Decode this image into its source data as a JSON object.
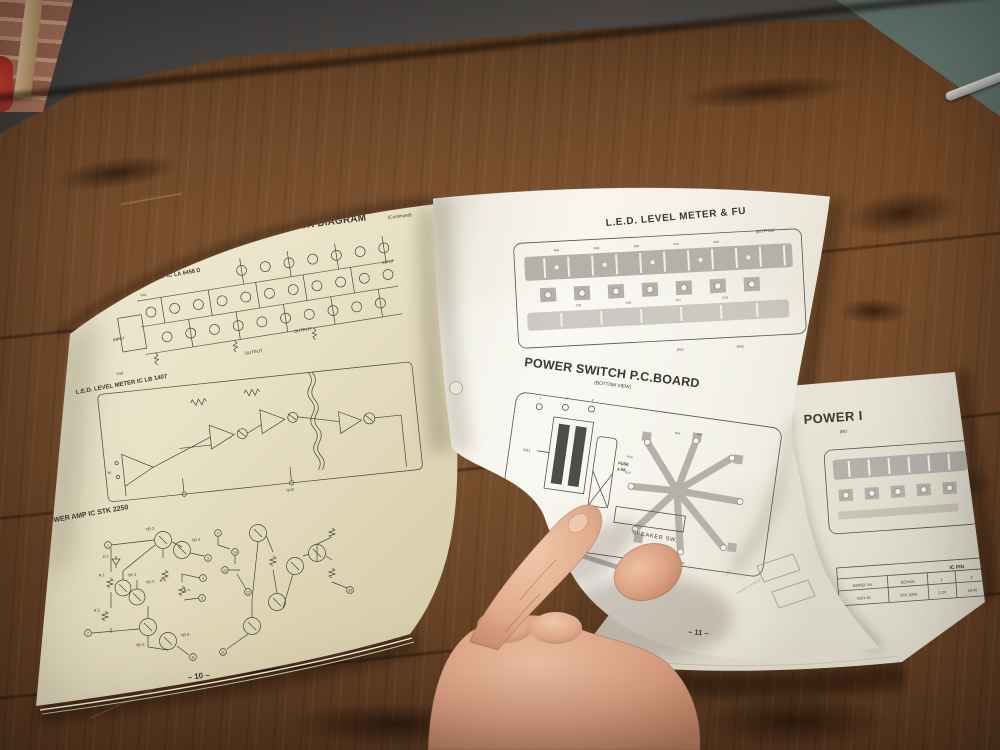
{
  "left_page": {
    "title": "IC EQUIVALENT CIRCUIT & BLOCK DIAGRAM",
    "title_suffix": "(Continued)",
    "section_phono": "PHONO EQ / PREAMP IC LA 6458 D",
    "section_led": "L.E.D. LEVEL METER IC LB 1407",
    "section_power": "POWER AMP IC STK 2250",
    "labels": {
      "vcc": "Vcc",
      "vref": "Vref",
      "input_left": "INPUT",
      "input_right": "INPUT",
      "output_1": "OUTPUT",
      "output_2": "OUTPUT",
      "in": "IN",
      "gnd": "GND"
    },
    "power_amp": {
      "tr": [
        "TR 3",
        "TR 4",
        "TR 1",
        "TR 2",
        "TR 5",
        "TR 6"
      ],
      "r": [
        "R 1",
        "R 2",
        "R 3",
        "R 4"
      ],
      "d": "D 1",
      "pins": [
        "1",
        "7",
        "3",
        "4",
        "5",
        "6",
        "11",
        "14",
        "10",
        "13",
        "12",
        "2"
      ]
    },
    "page_number": "– 10 –"
  },
  "turning_page": {
    "title": "L.E.D. LEVEL METER & FU",
    "title_sub": "(BOTTOM",
    "led_board_refs": [
      "R04",
      "R05",
      "R06",
      "R10",
      "R13"
    ],
    "led_board_refs2": [
      "D05",
      "D09",
      "D11",
      "D13"
    ],
    "jp_labels": [
      "JP02",
      "JP03"
    ],
    "ps_title": "POWER SWITCH P.C.BOARD",
    "ps_sub": "(BOTTOM VIEW)",
    "cd1": "CD1",
    "fuse_line1": "FUSE",
    "fuse_line2": "4.0A",
    "ps_pins": [
      "1",
      "2",
      "3"
    ],
    "ps_refs": [
      "R04",
      "R03",
      "R12",
      "R13",
      "R08"
    ],
    "speaker_sw": "SPEAKER SW.",
    "page_number": "– 11 –",
    "ghost_page_number": "– 13 –",
    "ghost_label": "HEAD PHONE"
  },
  "under_page": {
    "title": "POWER I",
    "title_sub": "(BO",
    "table": {
      "title": "IC PIN",
      "col_headers": [
        "MODEL No.",
        "DEVICE",
        "1",
        "2"
      ],
      "row": [
        "KCH-10",
        "STK 2250",
        "1.2V",
        "28.4V"
      ]
    }
  }
}
